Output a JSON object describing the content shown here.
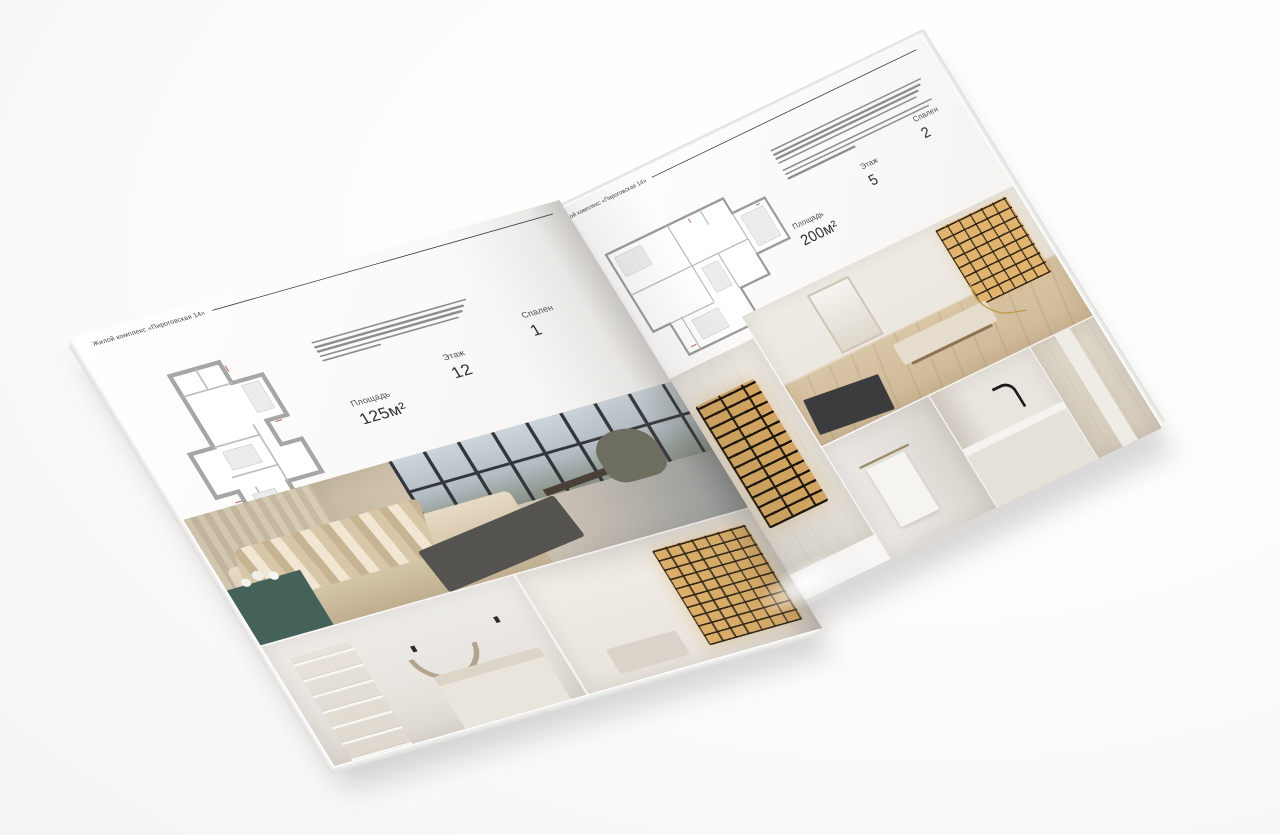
{
  "background_color": "#fbfbfb",
  "brochure": {
    "left_page": {
      "header": "Жилой комплекс «Пироговская 14»",
      "floorplan": {
        "name": "floorplan-125"
      },
      "description_line_widths": [
        100,
        97,
        94,
        90,
        38
      ],
      "specs": {
        "area_label": "Площадь",
        "area_value": "125м²",
        "floor_label": "Этаж",
        "floor_value": "12",
        "bedrooms_label": "Спален",
        "bedrooms_value": "1"
      },
      "photos": [
        {
          "name": "bedroom-with-panoramic-windows"
        },
        {
          "name": "white-bedroom-with-arc-decor"
        },
        {
          "name": "hallway-with-lit-bookshelves"
        }
      ]
    },
    "right_page": {
      "header": "Жилой комплекс «Пироговская 14»",
      "floorplan": {
        "name": "floorplan-200"
      },
      "description_line_widths": [
        100,
        98,
        95,
        92,
        0,
        99,
        96,
        45
      ],
      "specs": {
        "area_label": "Площадь",
        "area_value": "200м²",
        "floor_label": "Этаж",
        "floor_value": "5",
        "bedrooms_label": "Спален",
        "bedrooms_value": "2"
      },
      "photos": [
        {
          "name": "wardrobe-with-lit-display-cabinet"
        },
        {
          "name": "study-with-bookshelf-and-bench"
        },
        {
          "name": "bathroom-with-towel-rail"
        },
        {
          "name": "kitchen-island-with-black-faucet"
        },
        {
          "name": "light-kitchen-cabinets"
        }
      ]
    },
    "colors": {
      "paper": "#f7f6f4",
      "text": "#3f3f3f",
      "rule": "#3a3a3a",
      "plan_wall": "#a6a6a6",
      "photo_beige": "#cfc2ab",
      "warm_glow": "#d9ab62",
      "teal_cabinet": "#45625a",
      "dark_furniture": "#55534f"
    }
  }
}
